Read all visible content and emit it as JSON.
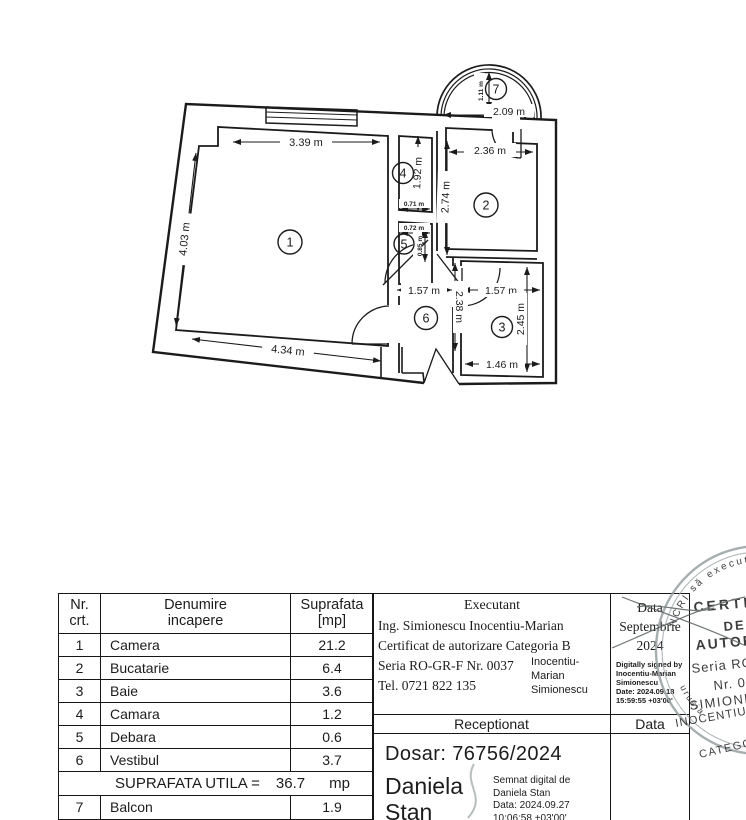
{
  "plan": {
    "room_labels": [
      "1",
      "2",
      "3",
      "4",
      "5",
      "6",
      "7"
    ],
    "dims": {
      "d339": "3.39 m",
      "d403": "4.03 m",
      "d434": "4.34 m",
      "d192": "1.92 m",
      "d274": "2.74 m",
      "d236": "2.36 m",
      "d209": "2.09 m",
      "d111": "1.11 m",
      "d071": "0.71 m",
      "d072": "0.72 m",
      "d085": "0.85 m",
      "d157a": "1.57 m",
      "d157b": "1.57 m",
      "d238": "2.38 m",
      "d245": "2.45 m",
      "d146": "1.46 m"
    }
  },
  "table": {
    "header": {
      "col1_line1": "Nr.",
      "col1_line2": "crt.",
      "col2_line1": "Denumire",
      "col2_line2": "incapere",
      "col3_line1": "Suprafata",
      "col3_line2": "[mp]"
    },
    "rows": [
      {
        "nr": "1",
        "name": "Camera",
        "area": "21.2"
      },
      {
        "nr": "2",
        "name": "Bucatarie",
        "area": "6.4"
      },
      {
        "nr": "3",
        "name": "Baie",
        "area": "3.6"
      },
      {
        "nr": "4",
        "name": "Camara",
        "area": "1.2"
      },
      {
        "nr": "5",
        "name": "Debara",
        "area": "0.6"
      },
      {
        "nr": "6",
        "name": "Vestibul",
        "area": "3.7"
      }
    ],
    "total": {
      "label": "SUPRAFATA UTILA =",
      "value": "36.7",
      "unit": "mp"
    },
    "extra_row": {
      "nr": "7",
      "name": "Balcon",
      "area": "1.9"
    }
  },
  "executant": {
    "title": "Executant",
    "line1": "Ing. Simionescu Inocentiu-Marian",
    "line2": "Certificat de autorizare Categoria B",
    "line3": "Seria RO-GR-F Nr. 0037",
    "line4": "Tel. 0721 822 135",
    "sig_line1": "Inocentiu-",
    "sig_line2": "Marian",
    "sig_line3": "Simionescu"
  },
  "data_box": {
    "label": "Data",
    "month": "Septembrie",
    "year": "2024",
    "sig_line1": "Digitally signed by",
    "sig_line2": "Inocentiu-Marian",
    "sig_line3": "Simionescu",
    "sig_line4": "Date: 2024.09.18",
    "sig_line5": "15:59:55 +03'00'"
  },
  "reception": {
    "label": "Receptionat",
    "data_label": "Data",
    "dosar": "Dosar: 76756/2024",
    "signer_first": "Daniela",
    "signer_last": "Stan",
    "sig_line1": "Semnat digital de",
    "sig_line2": "Daniela Stan",
    "sig_line3": "Data: 2024.09.27",
    "sig_line4": "10:06:58 +03'00'"
  },
  "stamp": {
    "ring_top": "NCRI să execute lu",
    "ring_bottom": "urusia",
    "line1": "CERTIFIC",
    "line2": "DE",
    "line3": "AUTORIZ",
    "line4": "Seria RO-",
    "line5": "Nr. 00",
    "line6": "SIMIONE",
    "line7": "INOCENTIU",
    "line8": "CATEGO"
  }
}
